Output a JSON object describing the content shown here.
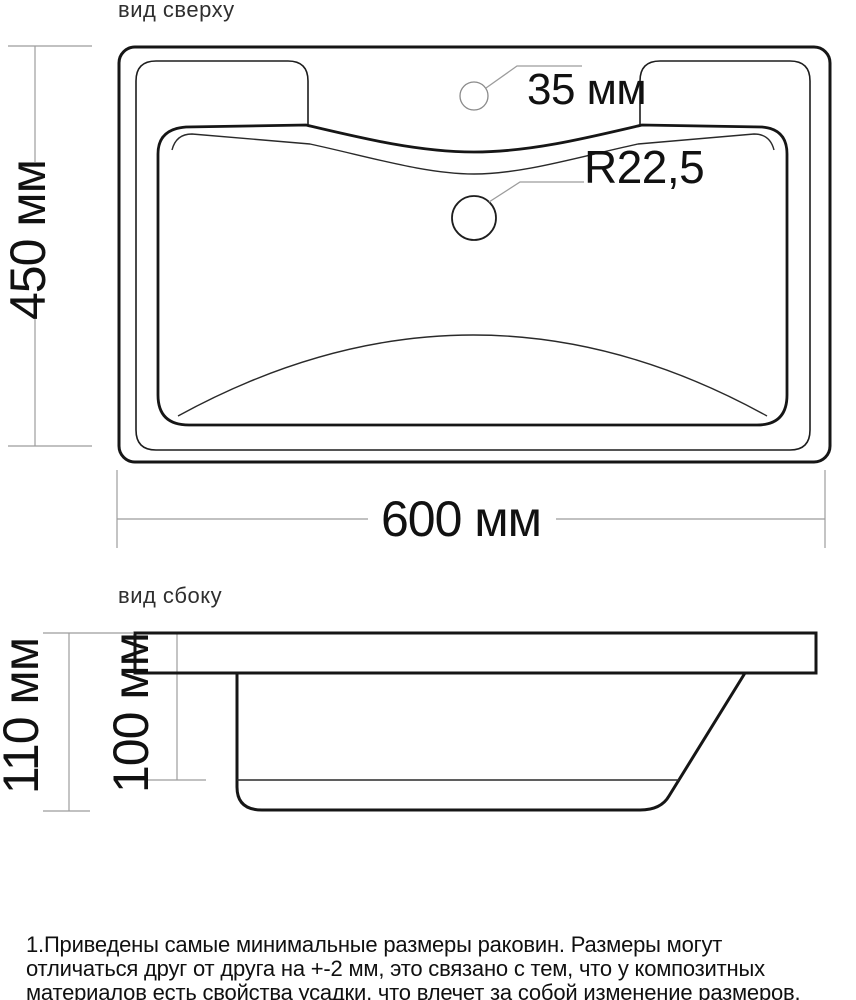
{
  "top_view": {
    "title": "вид сверху",
    "height_label": "450 мм",
    "width_label": "600 мм",
    "faucet_hole_label": "35 мм",
    "drain_radius_label": "R22,5"
  },
  "side_view": {
    "title": "вид сбоку",
    "total_height_label": "110 мм",
    "basin_depth_label": "100 мм"
  },
  "notes": {
    "line1": "1.Приведены самые минимальные размеры раковин. Размеры могут",
    "line2": "отличаться друг от друга на +-2 мм, это связано с тем, что у композитных",
    "line3": "материалов есть свойства усадки, что влечет за собой изменение размеров."
  },
  "colors": {
    "line": "#161616",
    "dimension": "#9c9c9c",
    "background": "#ffffff"
  }
}
